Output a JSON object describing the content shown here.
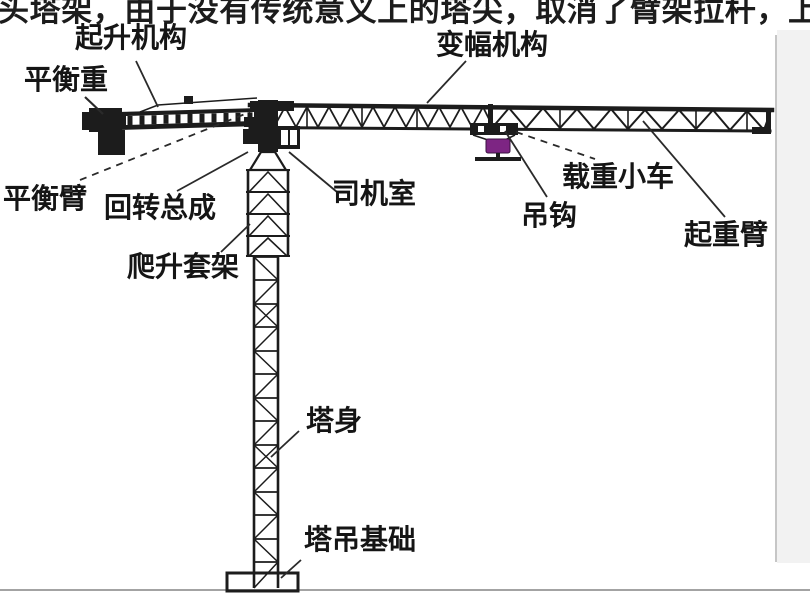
{
  "top_text": {
    "value": "头塔架，由于没有传统意义上的塔尖，取消了臂架拉杆，上"
  },
  "labels": {
    "hoisting": {
      "text": "起升机构"
    },
    "counterweight": {
      "text": "平衡重"
    },
    "counter_jib": {
      "text": "平衡臂"
    },
    "slewing": {
      "text": "回转总成"
    },
    "cab": {
      "text": "司机室"
    },
    "climbing": {
      "text": "爬升套架"
    },
    "luffing": {
      "text": "变幅机构"
    },
    "trolley": {
      "text": "载重小车"
    },
    "hook": {
      "text": "吊钩"
    },
    "jib": {
      "text": "起重臂"
    },
    "tower": {
      "text": "塔身"
    },
    "foundation": {
      "text": "塔吊基础"
    }
  },
  "colors": {
    "structure": "#1c1c1c",
    "leader_line": "#2a2a2a",
    "label_text": "#151515",
    "hook_block": "#7d2583",
    "hook_block_outline": "#3a1140",
    "right_strip": "#f2f2f2",
    "right_edge_line": "#c6c6c6",
    "bottom_line": "#a3a3a3",
    "background": "#ffffff"
  }
}
